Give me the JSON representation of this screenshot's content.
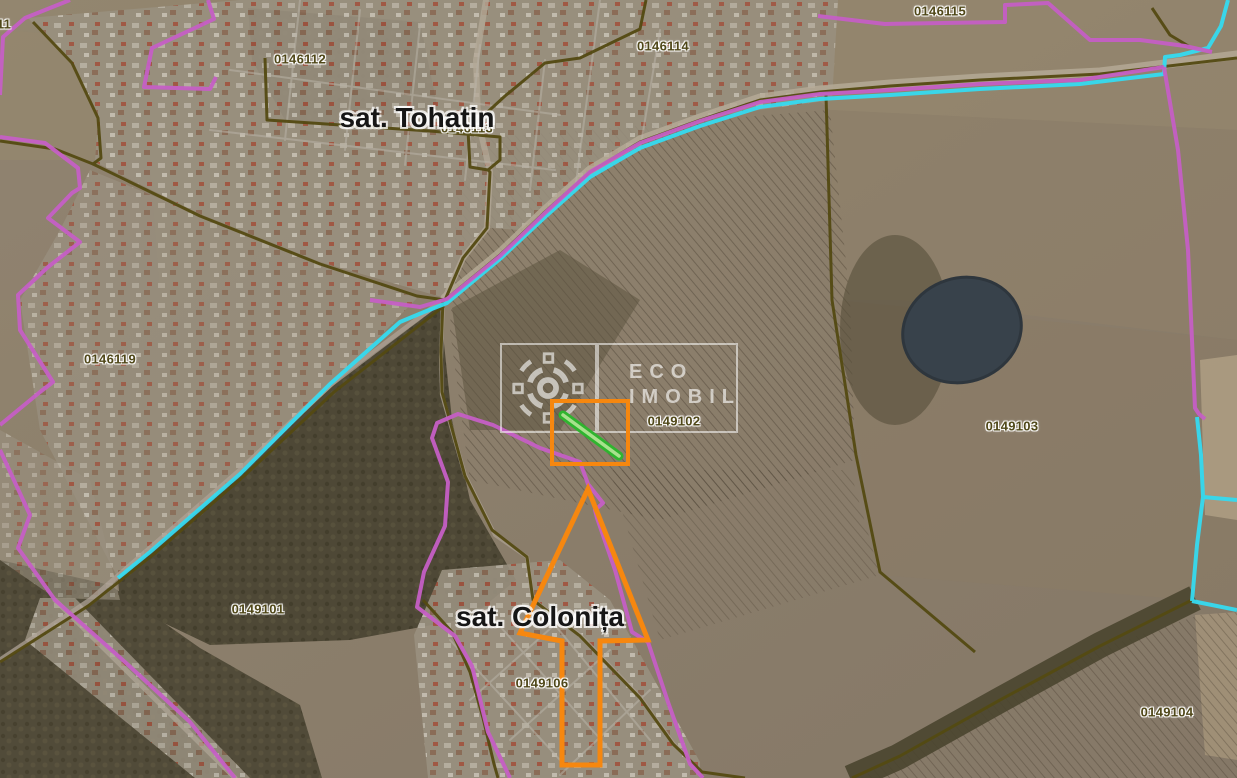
{
  "map": {
    "type": "satellite-cadastral-map",
    "village_labels": [
      {
        "name": "sat. Tohatin"
      },
      {
        "name": "sat. Colonița"
      }
    ],
    "parcel_labels": [
      {
        "id": "11"
      },
      {
        "id": "0146112"
      },
      {
        "id": "0146113"
      },
      {
        "id": "0146114"
      },
      {
        "id": "0146115"
      },
      {
        "id": "0146119"
      },
      {
        "id": "0149101"
      },
      {
        "id": "0149102"
      },
      {
        "id": "0149103"
      },
      {
        "id": "0149104"
      },
      {
        "id": "0149106"
      }
    ]
  },
  "watermark": {
    "logo": "qr-rosette-logo",
    "line1": "ECO",
    "line2": "IMOBIL"
  },
  "annotations": {
    "rectangle": "selected-area-rectangle",
    "green_strip": "selected-parcel-strip",
    "arrow": "pointer-arrow-up"
  },
  "colors": {
    "parcel_boundary_purple": "#c55fc5",
    "hydro_boundary_cyan": "#35daf0",
    "road_boundary_olive": "#544a12",
    "highlight_orange": "#f6870f",
    "highlight_green": "#2fb42f",
    "parcel_label_text": "#4f4718",
    "village_label_text": "#161616"
  }
}
